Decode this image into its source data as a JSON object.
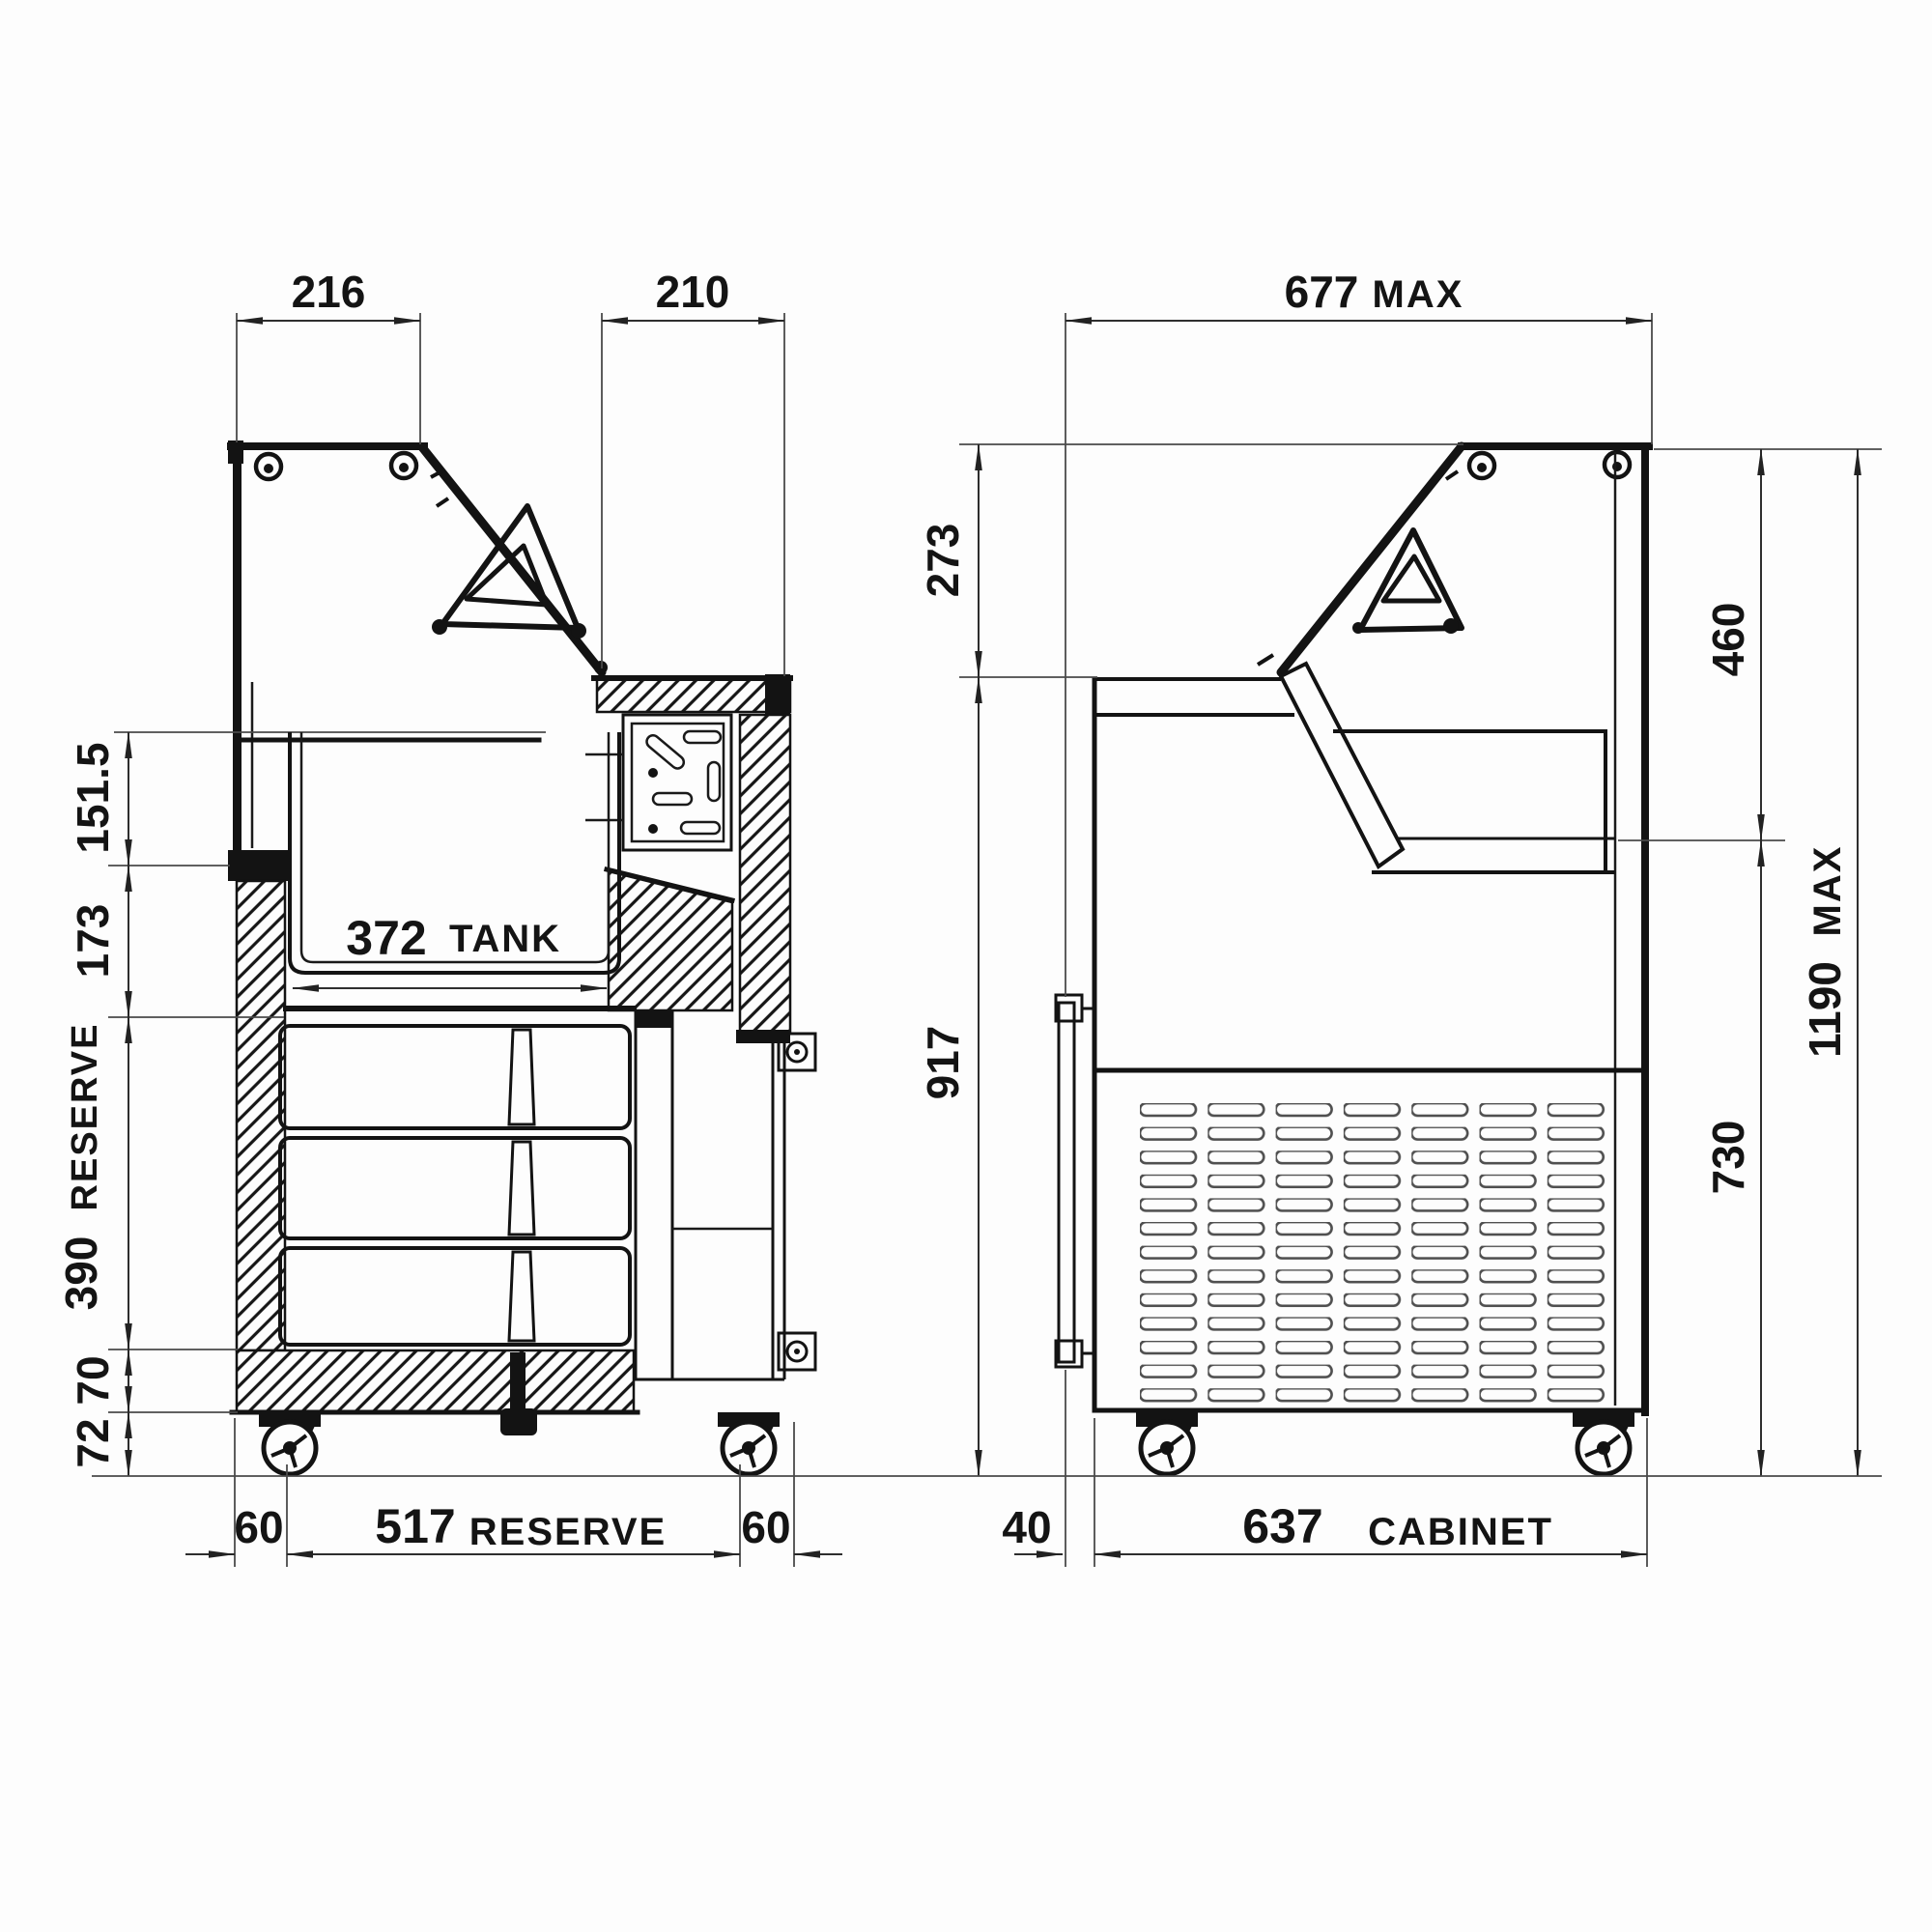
{
  "drawing": {
    "colors": {
      "background": "#fdfdfd",
      "ink": "#131313",
      "dim_lines": "#2e2e2e"
    },
    "left_view": {
      "name": "side section view",
      "top_dims": [
        {
          "v": "216"
        },
        {
          "v": "210"
        }
      ],
      "side_dims": [
        {
          "v": "151.5"
        },
        {
          "v": "173"
        },
        {
          "v": "390",
          "word": "RESERVE"
        },
        {
          "v": "70"
        },
        {
          "v": "72"
        }
      ],
      "tank": {
        "v": "372",
        "word": "TANK"
      },
      "bottom_dims": [
        {
          "v": "60"
        },
        {
          "v": "517",
          "word": "RESERVE"
        },
        {
          "v": "60"
        }
      ]
    },
    "right_view": {
      "name": "front section view",
      "top_dims": [
        {
          "v": "677",
          "word": "MAX"
        }
      ],
      "left_dims": [
        {
          "v": "273"
        },
        {
          "v": "917"
        }
      ],
      "right_dims": [
        {
          "v": "460"
        },
        {
          "v": "730"
        },
        {
          "v": "1190",
          "word": "MAX"
        }
      ],
      "bottom_dims": [
        {
          "v": "40"
        },
        {
          "v": "637",
          "word": "CABINET"
        }
      ]
    }
  }
}
